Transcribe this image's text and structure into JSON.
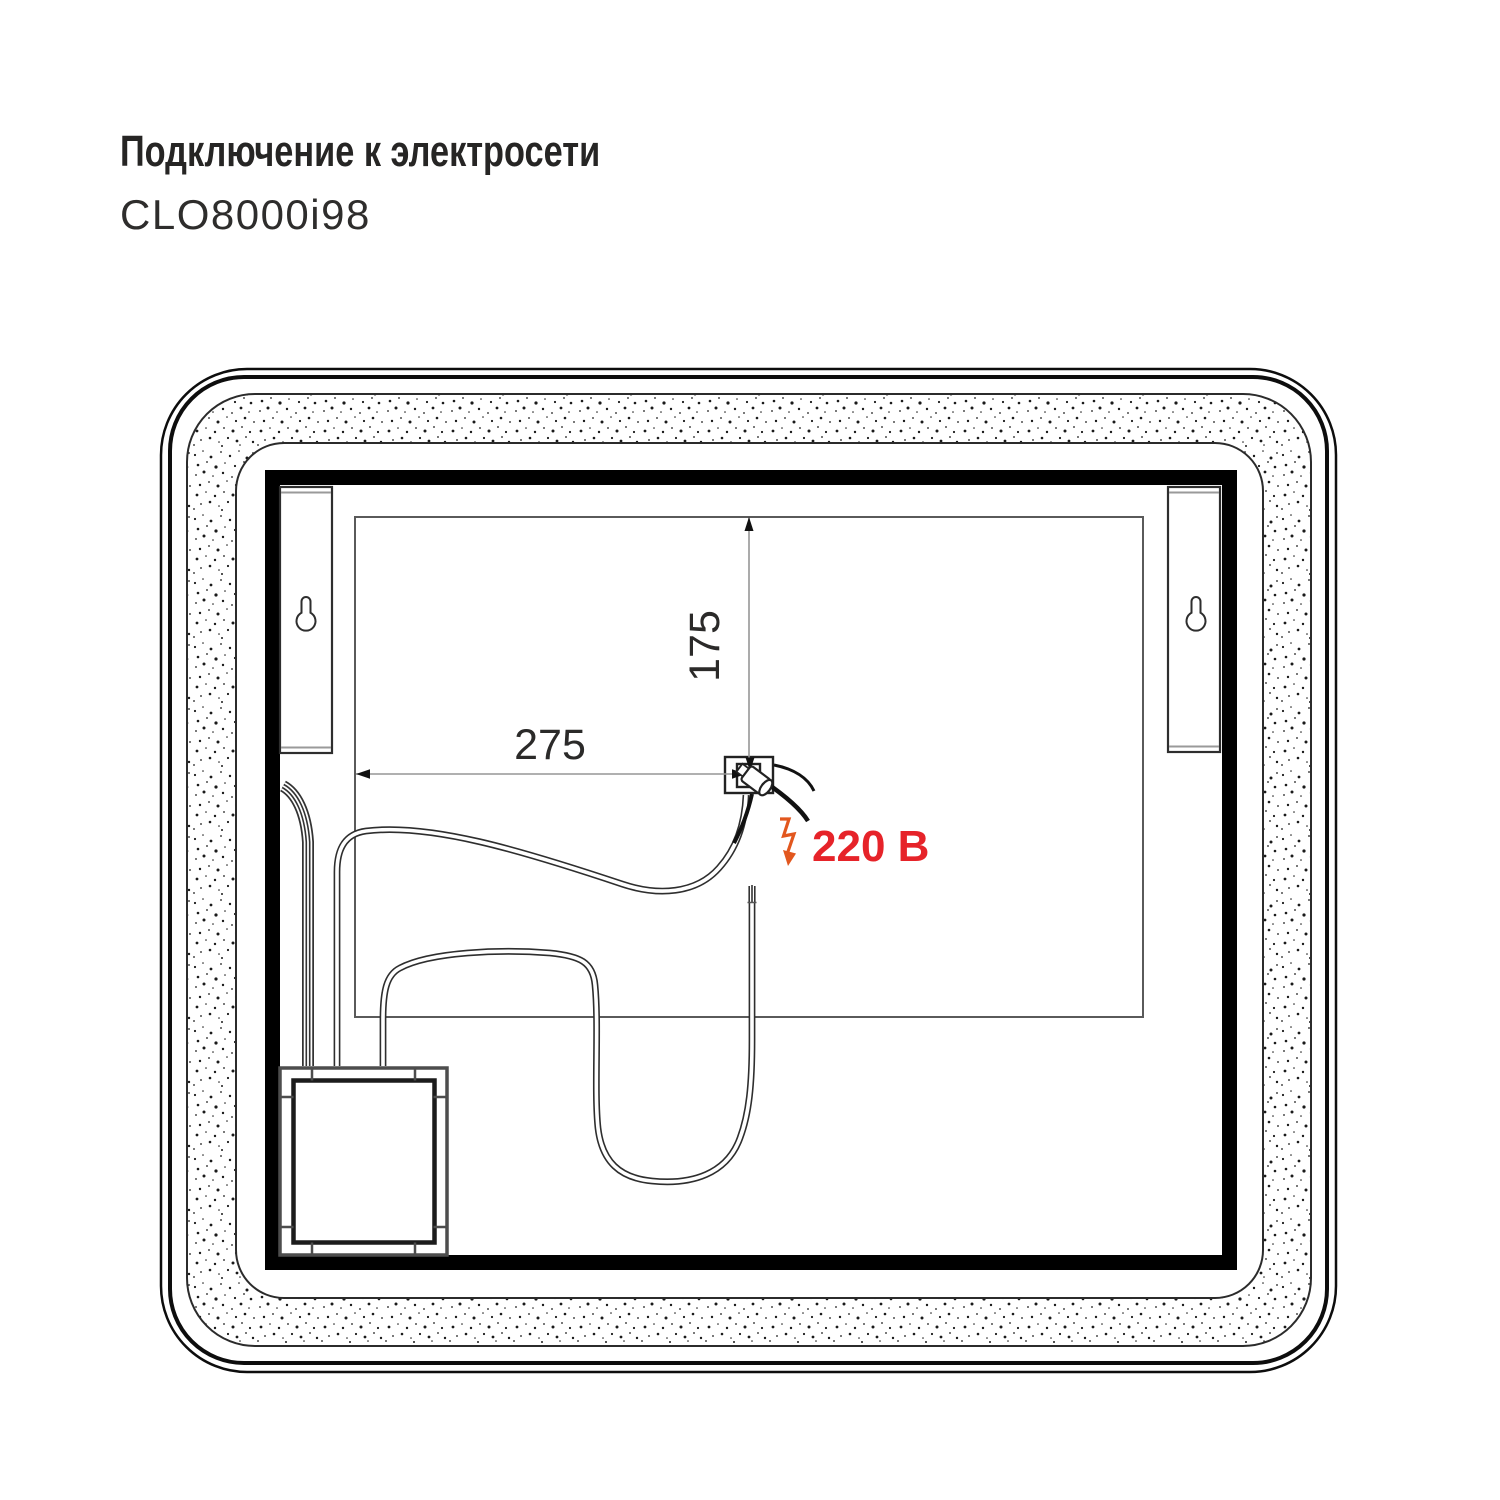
{
  "header": {
    "title": "Подключение к электросети",
    "model": "CLO8000i98"
  },
  "diagram": {
    "dim_vertical": "175",
    "dim_horizontal": "275",
    "voltage_label": "220 В",
    "colors": {
      "voltage_red": "#e62329",
      "bolt_orange": "#e2571e",
      "line_dark": "#2b2a29",
      "line_gray": "#969696"
    }
  }
}
